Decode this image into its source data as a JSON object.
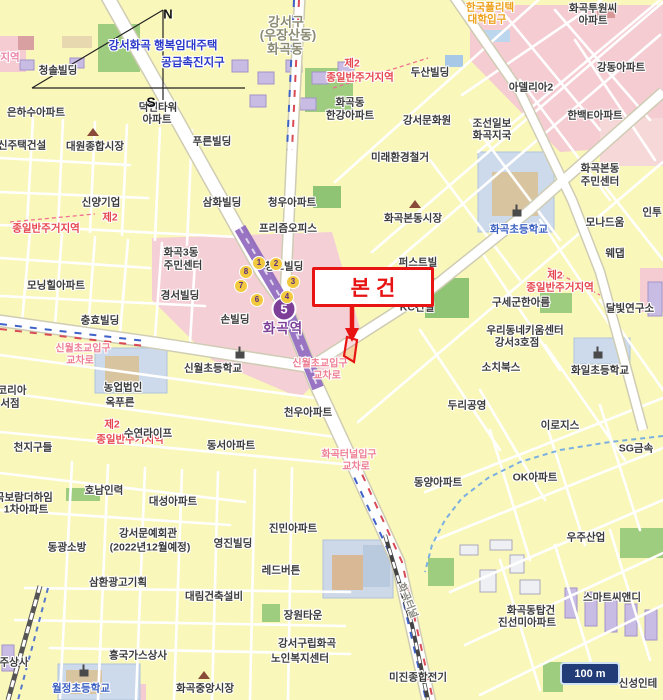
{
  "map": {
    "title_note": "appraisal location map around Hwagok station",
    "colors": {
      "accent_red": "#e81414",
      "line5_purple": "#7d3f98",
      "exit_yellow": "#f2c93e",
      "junction_pink": "#ee7f93",
      "district_red": "#e6474e",
      "project_blue": "#2b39c8",
      "road_orange": "#eda019",
      "school_blue": "#3a5fc0",
      "scale_navy": "#223c78",
      "block_yellow": "#faf7bb",
      "zone_pink": "#f5cfd6",
      "park_green": "#9fcd7f"
    },
    "callout": {
      "label": "본건"
    },
    "scale_bar": {
      "label": "100 m"
    },
    "compass": {
      "north": "N",
      "south": "S"
    },
    "station": {
      "name": "화곡역",
      "line_badge": "5",
      "exits": [
        {
          "n": "1",
          "x": 259,
          "y": 263
        },
        {
          "n": "2",
          "x": 276,
          "y": 264
        },
        {
          "n": "3",
          "x": 293,
          "y": 282
        },
        {
          "n": "4",
          "x": 287,
          "y": 297
        },
        {
          "n": "6",
          "x": 257,
          "y": 300
        },
        {
          "n": "7",
          "x": 241,
          "y": 286
        },
        {
          "n": "8",
          "x": 246,
          "y": 272
        }
      ]
    },
    "labels": [
      {
        "t": "강서구",
        "x": 286,
        "y": 21,
        "k": "a"
      },
      {
        "t": "(우장산동)",
        "x": 288,
        "y": 34,
        "k": "a"
      },
      {
        "t": "화곡동",
        "x": 285,
        "y": 48,
        "k": "a"
      },
      {
        "t": "강서화곡 행복임대주택",
        "x": 163,
        "y": 45,
        "k": "p"
      },
      {
        "t": "공급촉진지구",
        "x": 193,
        "y": 62,
        "k": "p"
      },
      {
        "t": "제2",
        "x": 352,
        "y": 63,
        "k": "d"
      },
      {
        "t": "종일반주거지역",
        "x": 360,
        "y": 77,
        "k": "d"
      },
      {
        "t": "제2",
        "x": 110,
        "y": 217,
        "k": "d"
      },
      {
        "t": "종일반주거지역",
        "x": 46,
        "y": 228,
        "k": "d"
      },
      {
        "t": "제2",
        "x": 555,
        "y": 275,
        "k": "d"
      },
      {
        "t": "종일반주거지역",
        "x": 560,
        "y": 287,
        "k": "d"
      },
      {
        "t": "제2",
        "x": 112,
        "y": 424,
        "k": "d"
      },
      {
        "t": "종일반주거지역",
        "x": 130,
        "y": 439,
        "k": "d"
      },
      {
        "t": "지역",
        "x": 10,
        "y": 57,
        "k": "d2"
      },
      {
        "t": "한국폴리텍",
        "x": 490,
        "y": 7,
        "k": "o"
      },
      {
        "t": "대학입구",
        "x": 487,
        "y": 19,
        "k": "o"
      },
      {
        "t": "신월초교입구",
        "x": 83,
        "y": 347,
        "k": "j"
      },
      {
        "t": "교차로",
        "x": 80,
        "y": 359,
        "k": "j"
      },
      {
        "t": "신월초교입구",
        "x": 320,
        "y": 362,
        "k": "j"
      },
      {
        "t": "교차로",
        "x": 327,
        "y": 374,
        "k": "j"
      },
      {
        "t": "화곡터널입구",
        "x": 349,
        "y": 453,
        "k": "j"
      },
      {
        "t": "교차로",
        "x": 356,
        "y": 465,
        "k": "j"
      },
      {
        "t": "화곡터널",
        "x": 409,
        "y": 600,
        "k": "t"
      },
      {
        "t": "화곡역",
        "x": 283,
        "y": 327,
        "k": "st"
      },
      {
        "t": "화곡초등학교",
        "x": 519,
        "y": 229,
        "k": "s"
      },
      {
        "t": "월정초등학교",
        "x": 81,
        "y": 688,
        "k": "s"
      },
      {
        "t": "청솔빌딩",
        "x": 58,
        "y": 70,
        "k": "b"
      },
      {
        "t": "은하수아파트",
        "x": 36,
        "y": 112,
        "k": "b"
      },
      {
        "t": "덕헌타워",
        "x": 158,
        "y": 107,
        "k": "b"
      },
      {
        "t": "아파트",
        "x": 157,
        "y": 119,
        "k": "b"
      },
      {
        "t": "화곡투원씨",
        "x": 593,
        "y": 8,
        "k": "b"
      },
      {
        "t": "아파트",
        "x": 593,
        "y": 20,
        "k": "b"
      },
      {
        "t": "강동아파트",
        "x": 621,
        "y": 67,
        "k": "b"
      },
      {
        "t": "아델리아2",
        "x": 531,
        "y": 87,
        "k": "b"
      },
      {
        "t": "한백E아파트",
        "x": 595,
        "y": 115,
        "k": "b"
      },
      {
        "t": "두산빌딩",
        "x": 430,
        "y": 72,
        "k": "b"
      },
      {
        "t": "화곡동",
        "x": 350,
        "y": 102,
        "k": "b"
      },
      {
        "t": "한강아파트",
        "x": 350,
        "y": 115,
        "k": "b"
      },
      {
        "t": "강서문화원",
        "x": 427,
        "y": 120,
        "k": "b"
      },
      {
        "t": "조선일보",
        "x": 492,
        "y": 123,
        "k": "b"
      },
      {
        "t": "화곡지국",
        "x": 492,
        "y": 135,
        "k": "b"
      },
      {
        "t": "미래환경철거",
        "x": 400,
        "y": 157,
        "k": "b"
      },
      {
        "t": "화곡본동",
        "x": 600,
        "y": 168,
        "k": "b"
      },
      {
        "t": "주민센터",
        "x": 600,
        "y": 181,
        "k": "b"
      },
      {
        "t": "푸른빌딩",
        "x": 212,
        "y": 141,
        "k": "b"
      },
      {
        "t": "신주택건설",
        "x": 22,
        "y": 145,
        "k": "b"
      },
      {
        "t": "대원종합시장",
        "x": 95,
        "y": 146,
        "k": "b"
      },
      {
        "t": "신양기업",
        "x": 101,
        "y": 202,
        "k": "b"
      },
      {
        "t": "삼화빌딩",
        "x": 222,
        "y": 202,
        "k": "b"
      },
      {
        "t": "청우아파트",
        "x": 292,
        "y": 202,
        "k": "b"
      },
      {
        "t": "프리즘오피스",
        "x": 288,
        "y": 228,
        "k": "b"
      },
      {
        "t": "화곡본동시장",
        "x": 413,
        "y": 218,
        "k": "b"
      },
      {
        "t": "모나드움",
        "x": 605,
        "y": 222,
        "k": "b"
      },
      {
        "t": "인투",
        "x": 652,
        "y": 212,
        "k": "b"
      },
      {
        "t": "웨댑",
        "x": 615,
        "y": 253,
        "k": "b"
      },
      {
        "t": "화곡3동",
        "x": 181,
        "y": 252,
        "k": "b"
      },
      {
        "t": "주민센터",
        "x": 183,
        "y": 265,
        "k": "b"
      },
      {
        "t": "경서빌딩",
        "x": 180,
        "y": 295,
        "k": "b"
      },
      {
        "t": "모닝힐아파트",
        "x": 56,
        "y": 285,
        "k": "b"
      },
      {
        "t": "충효빌딩",
        "x": 100,
        "y": 320,
        "k": "b"
      },
      {
        "t": "청도빌딩",
        "x": 284,
        "y": 266,
        "k": "b"
      },
      {
        "t": "손빌딩",
        "x": 235,
        "y": 319,
        "k": "b"
      },
      {
        "t": "KC건설",
        "x": 417,
        "y": 307,
        "k": "b"
      },
      {
        "t": "퍼스트빌",
        "x": 418,
        "y": 262,
        "k": "b"
      },
      {
        "t": "구세군한아름",
        "x": 521,
        "y": 302,
        "k": "b"
      },
      {
        "t": "달빛연구소",
        "x": 630,
        "y": 308,
        "k": "b"
      },
      {
        "t": "우리동네키움센터",
        "x": 525,
        "y": 330,
        "k": "b"
      },
      {
        "t": "강서3호점",
        "x": 517,
        "y": 342,
        "k": "b"
      },
      {
        "t": "소치북스",
        "x": 501,
        "y": 367,
        "k": "b"
      },
      {
        "t": "화일초등학교",
        "x": 600,
        "y": 370,
        "k": "b"
      },
      {
        "t": "신월초등학교",
        "x": 213,
        "y": 368,
        "k": "b"
      },
      {
        "t": "두리공영",
        "x": 467,
        "y": 405,
        "k": "b"
      },
      {
        "t": "이로지스",
        "x": 560,
        "y": 425,
        "k": "b"
      },
      {
        "t": "SG금속",
        "x": 636,
        "y": 448,
        "k": "b"
      },
      {
        "t": "OK아파트",
        "x": 535,
        "y": 477,
        "k": "b"
      },
      {
        "t": "동양아파트",
        "x": 438,
        "y": 482,
        "k": "b"
      },
      {
        "t": "천우아파트",
        "x": 308,
        "y": 412,
        "k": "b"
      },
      {
        "t": "동서아파트",
        "x": 231,
        "y": 445,
        "k": "b"
      },
      {
        "t": "수연라이프",
        "x": 148,
        "y": 433,
        "k": "b"
      },
      {
        "t": "농업법인",
        "x": 123,
        "y": 387,
        "k": "b"
      },
      {
        "t": "옥푸른",
        "x": 120,
        "y": 402,
        "k": "b"
      },
      {
        "t": "천지구들",
        "x": 33,
        "y": 447,
        "k": "b"
      },
      {
        "t": "코리아",
        "x": 12,
        "y": 390,
        "k": "b"
      },
      {
        "t": "서점",
        "x": 10,
        "y": 403,
        "k": "b"
      },
      {
        "t": "대성아파트",
        "x": 173,
        "y": 501,
        "k": "b"
      },
      {
        "t": "호남인력",
        "x": 104,
        "y": 490,
        "k": "b"
      },
      {
        "t": "화곡보람더하임",
        "x": 19,
        "y": 497,
        "k": "b"
      },
      {
        "t": "1차아파트",
        "x": 26,
        "y": 509,
        "k": "b"
      },
      {
        "t": "동광소방",
        "x": 67,
        "y": 547,
        "k": "b"
      },
      {
        "t": "강서문예회관",
        "x": 148,
        "y": 533,
        "k": "b"
      },
      {
        "t": "(2022년12월예정)",
        "x": 150,
        "y": 547,
        "k": "b"
      },
      {
        "t": "영진빌딩",
        "x": 233,
        "y": 543,
        "k": "b"
      },
      {
        "t": "진민아파트",
        "x": 293,
        "y": 528,
        "k": "b"
      },
      {
        "t": "레드버튼",
        "x": 281,
        "y": 570,
        "k": "b"
      },
      {
        "t": "대림건축설비",
        "x": 214,
        "y": 596,
        "k": "b"
      },
      {
        "t": "장원타운",
        "x": 303,
        "y": 615,
        "k": "b"
      },
      {
        "t": "강서구립화곡",
        "x": 307,
        "y": 643,
        "k": "b"
      },
      {
        "t": "노인복지센터",
        "x": 300,
        "y": 658,
        "k": "b"
      },
      {
        "t": "삼환광고기획",
        "x": 118,
        "y": 582,
        "k": "b"
      },
      {
        "t": "흥국가스상사",
        "x": 138,
        "y": 655,
        "k": "b"
      },
      {
        "t": "화곡중앙시장",
        "x": 205,
        "y": 688,
        "k": "b"
      },
      {
        "t": "주상사",
        "x": 14,
        "y": 662,
        "k": "b"
      },
      {
        "t": "미진종합전기",
        "x": 418,
        "y": 677,
        "k": "b"
      },
      {
        "t": "화곡동탑건",
        "x": 531,
        "y": 610,
        "k": "b"
      },
      {
        "t": "진선미아파트",
        "x": 527,
        "y": 622,
        "k": "b"
      },
      {
        "t": "스마트씨앤디",
        "x": 612,
        "y": 597,
        "k": "b"
      },
      {
        "t": "신성인테",
        "x": 638,
        "y": 683,
        "k": "b"
      },
      {
        "t": "우주산업",
        "x": 586,
        "y": 537,
        "k": "b"
      }
    ],
    "icons": [
      {
        "k": "apartment-icon",
        "x": 37,
        "y": 99
      },
      {
        "k": "apartment-icon",
        "x": 157,
        "y": 95
      },
      {
        "k": "apartment-icon",
        "x": 622,
        "y": 54
      },
      {
        "k": "apartment-icon",
        "x": 530,
        "y": 73
      },
      {
        "k": "apartment-icon",
        "x": 593,
        "y": 102
      },
      {
        "k": "apartment-icon",
        "x": 348,
        "y": 89
      },
      {
        "k": "apartment-icon",
        "x": 597,
        "y": 152
      },
      {
        "k": "apartment-icon",
        "x": 291,
        "y": 189
      },
      {
        "k": "apartment-icon",
        "x": 208,
        "y": 236
      },
      {
        "k": "apartment-icon",
        "x": 56,
        "y": 271
      },
      {
        "k": "apartment-icon",
        "x": 536,
        "y": 462
      },
      {
        "k": "apartment-icon",
        "x": 439,
        "y": 467
      },
      {
        "k": "apartment-icon",
        "x": 310,
        "y": 399
      },
      {
        "k": "apartment-icon",
        "x": 233,
        "y": 431
      },
      {
        "k": "apartment-icon",
        "x": 173,
        "y": 488
      },
      {
        "k": "apartment-icon",
        "x": 304,
        "y": 601
      },
      {
        "k": "apartment-icon",
        "x": 529,
        "y": 596
      },
      {
        "k": "apartment-icon",
        "x": 359,
        "y": 684
      },
      {
        "k": "market-icon",
        "x": 93,
        "y": 132
      },
      {
        "k": "market-icon",
        "x": 415,
        "y": 204
      },
      {
        "k": "market-icon",
        "x": 204,
        "y": 675
      },
      {
        "k": "school-icon",
        "x": 517,
        "y": 213
      },
      {
        "k": "school-icon",
        "x": 84,
        "y": 673
      },
      {
        "k": "school-icon",
        "x": 598,
        "y": 355
      },
      {
        "k": "school-icon",
        "x": 240,
        "y": 355
      }
    ]
  }
}
